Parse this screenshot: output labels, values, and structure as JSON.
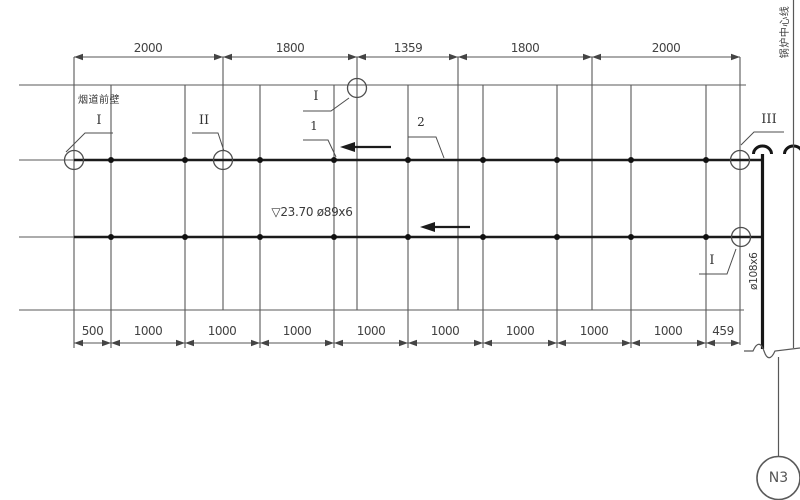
{
  "drawing_title": "pipe run layout elevation",
  "dimensions": {
    "top": [
      "2000",
      "1800",
      "1359",
      "1800",
      "2000"
    ],
    "bottom": [
      "500",
      "1000",
      "1000",
      "1000",
      "1000",
      "1000",
      "1000",
      "1000",
      "1000",
      "459"
    ]
  },
  "section_markers": {
    "left": "I",
    "second": "II",
    "top": "I",
    "right_top": "III",
    "right_bottom": "I"
  },
  "detail_labels": {
    "weld_1": "1",
    "weld_2": "2"
  },
  "annotations": {
    "wall_note": "烟道前壁",
    "elevation_pipe_note": "▽23.70 ø89x6",
    "riser_size_note": "ø108x6",
    "boiler_centerline_note": "锅炉中心线",
    "nozzle_tag": "N3"
  },
  "colors": {
    "thin_line": "#555555",
    "heavy_line": "#1b1b1b",
    "text": "#3d3d3d"
  }
}
